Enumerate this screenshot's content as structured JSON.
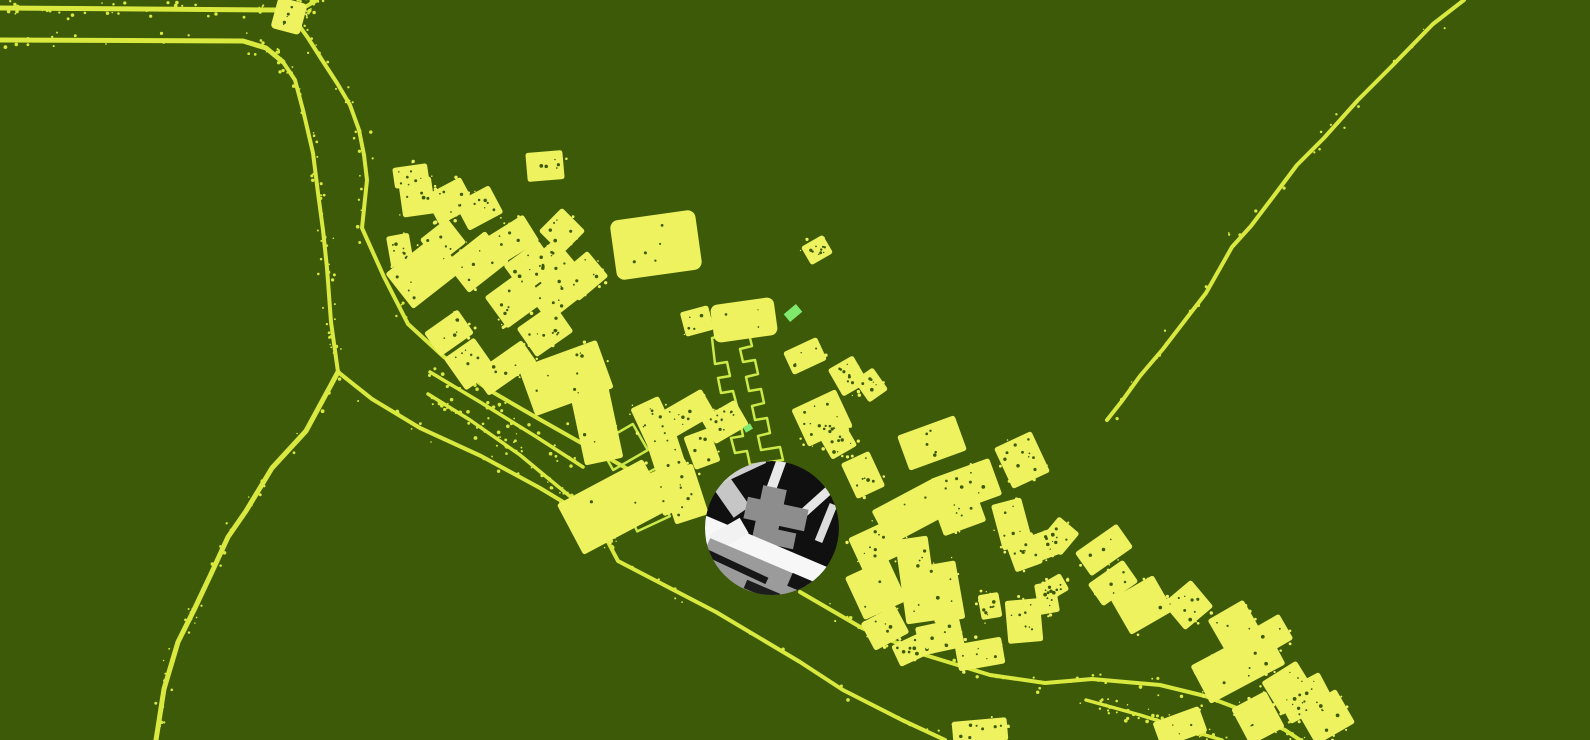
{
  "canvas": {
    "width": 1590,
    "height": 740
  },
  "colors": {
    "background": "#3c5a07",
    "building": "#eef25f",
    "road": "#d9e93f",
    "outline": "#cdea48",
    "accent_green": "#7fe96d",
    "lens_black": "#101010",
    "lens_white": "#f7f7f7",
    "lens_gray": "#9b9b9b"
  },
  "map": {
    "roads": [
      {
        "pts": [
          [
            0,
            8
          ],
          [
            278,
            10
          ]
        ],
        "w": 5
      },
      {
        "pts": [
          [
            300,
            10
          ],
          [
            317,
            0
          ]
        ],
        "w": 4
      },
      {
        "pts": [
          [
            0,
            40
          ],
          [
            243,
            41
          ],
          [
            266,
            48
          ],
          [
            283,
            62
          ]
        ],
        "w": 5
      },
      {
        "pts": [
          [
            283,
            62
          ],
          [
            295,
            80
          ],
          [
            303,
            110
          ],
          [
            313,
            153
          ],
          [
            318,
            193
          ],
          [
            323,
            230
          ],
          [
            327,
            268
          ],
          [
            331,
            322
          ],
          [
            338,
            372
          ]
        ],
        "w": 4
      },
      {
        "pts": [
          [
            298,
            24
          ],
          [
            308,
            38
          ],
          [
            322,
            60
          ],
          [
            337,
            83
          ],
          [
            350,
            105
          ],
          [
            359,
            130
          ],
          [
            364,
            155
          ],
          [
            367,
            180
          ],
          [
            362,
            228
          ],
          [
            384,
            277
          ],
          [
            408,
            324
          ],
          [
            444,
            357
          ],
          [
            489,
            390
          ],
          [
            539,
            419
          ],
          [
            592,
            449
          ],
          [
            642,
            477
          ],
          [
            690,
            503
          ]
        ],
        "w": 4
      },
      {
        "pts": [
          [
            338,
            372
          ],
          [
            306,
            431
          ],
          [
            272,
            468
          ],
          [
            246,
            511
          ],
          [
            228,
            537
          ],
          [
            211,
            574
          ],
          [
            194,
            610
          ],
          [
            178,
            642
          ],
          [
            164,
            689
          ],
          [
            156,
            740
          ]
        ],
        "w": 5
      },
      {
        "pts": [
          [
            338,
            372
          ],
          [
            372,
            399
          ],
          [
            420,
            428
          ],
          [
            481,
            456
          ],
          [
            540,
            488
          ],
          [
            598,
            523
          ],
          [
            618,
            561
          ],
          [
            666,
            586
          ],
          [
            716,
            612
          ],
          [
            800,
            662
          ],
          [
            843,
            690
          ],
          [
            902,
            720
          ],
          [
            945,
            740
          ]
        ],
        "w": 4
      },
      {
        "pts": [
          [
            800,
            592
          ],
          [
            862,
            628
          ],
          [
            925,
            655
          ],
          [
            990,
            675
          ],
          [
            1045,
            683
          ],
          [
            1092,
            679
          ],
          [
            1160,
            685
          ],
          [
            1205,
            696
          ],
          [
            1250,
            713
          ],
          [
            1285,
            730
          ],
          [
            1300,
            740
          ]
        ],
        "w": 4
      },
      {
        "pts": [
          [
            430,
            372
          ],
          [
            480,
            402
          ],
          [
            535,
            436
          ],
          [
            583,
            467
          ]
        ],
        "w": 3.5
      },
      {
        "pts": [
          [
            428,
            394
          ],
          [
            470,
            420
          ],
          [
            520,
            455
          ],
          [
            578,
            503
          ]
        ],
        "w": 3.5
      },
      {
        "pts": [
          [
            1086,
            700
          ],
          [
            1140,
            715
          ],
          [
            1195,
            732
          ],
          [
            1222,
            740
          ]
        ],
        "w": 3.5
      },
      {
        "pts": [
          [
            1464,
            0
          ],
          [
            1433,
            24
          ],
          [
            1392,
            66
          ],
          [
            1358,
            100
          ],
          [
            1324,
            138
          ],
          [
            1297,
            165
          ],
          [
            1276,
            193
          ],
          [
            1251,
            226
          ],
          [
            1232,
            247
          ],
          [
            1206,
            293
          ],
          [
            1186,
            319
          ],
          [
            1163,
            349
          ],
          [
            1140,
            376
          ],
          [
            1122,
            401
          ],
          [
            1107,
            420
          ]
        ],
        "w": 4
      }
    ],
    "buildings": [
      [
        289,
        16,
        22,
        24,
        15,
        8
      ],
      [
        411,
        176,
        30,
        16,
        -8
      ],
      [
        417,
        197,
        28,
        32,
        -8
      ],
      [
        450,
        201,
        36,
        28,
        -28
      ],
      [
        479,
        208,
        34,
        26,
        -28
      ],
      [
        400,
        250,
        18,
        26,
        -10
      ],
      [
        424,
        272,
        58,
        40,
        -38
      ],
      [
        443,
        241,
        30,
        26,
        -38
      ],
      [
        477,
        262,
        46,
        34,
        -38
      ],
      [
        513,
        239,
        38,
        26,
        -32
      ],
      [
        531,
        267,
        38,
        30,
        -36
      ],
      [
        562,
        231,
        28,
        28,
        -45
      ],
      [
        551,
        264,
        34,
        28,
        -40
      ],
      [
        515,
        299,
        42,
        34,
        -36
      ],
      [
        555,
        295,
        38,
        30,
        -38
      ],
      [
        583,
        276,
        34,
        28,
        -40
      ],
      [
        545,
        166,
        32,
        24,
        -5
      ],
      [
        656,
        245,
        70,
        44,
        -8,
        16
      ],
      [
        817,
        250,
        20,
        16,
        -30
      ],
      [
        697,
        321,
        24,
        20,
        -15
      ],
      [
        744,
        320,
        50,
        24,
        -8,
        14
      ],
      [
        449,
        333,
        36,
        24,
        -35
      ],
      [
        470,
        364,
        32,
        34,
        -35
      ],
      [
        505,
        368,
        54,
        22,
        -35
      ],
      [
        545,
        330,
        40,
        30,
        -35
      ],
      [
        566,
        378,
        78,
        46,
        -20
      ],
      [
        595,
        418,
        34,
        84,
        -12
      ],
      [
        688,
        413,
        42,
        24,
        -30
      ],
      [
        725,
        422,
        34,
        24,
        -30
      ],
      [
        702,
        449,
        22,
        30,
        -20
      ],
      [
        653,
        421,
        26,
        36,
        -25
      ],
      [
        674,
        487,
        38,
        40,
        -25
      ],
      [
        613,
        507,
        92,
        52,
        -28
      ],
      [
        665,
        450,
        26,
        44,
        -18
      ],
      [
        684,
        494,
        30,
        48,
        -18
      ],
      [
        805,
        356,
        32,
        20,
        -25
      ],
      [
        848,
        376,
        24,
        26,
        -30
      ],
      [
        871,
        385,
        18,
        22,
        -35
      ],
      [
        822,
        418,
        44,
        36,
        -25
      ],
      [
        827,
        428,
        16,
        14,
        -25
      ],
      [
        838,
        441,
        24,
        22,
        -30
      ],
      [
        863,
        475,
        26,
        34,
        -25
      ],
      [
        932,
        443,
        56,
        32,
        -20
      ],
      [
        966,
        487,
        58,
        34,
        -20
      ],
      [
        960,
        514,
        40,
        26,
        -20
      ],
      [
        1022,
        460,
        36,
        40,
        -25
      ],
      [
        1012,
        524,
        26,
        42,
        -15
      ],
      [
        1024,
        552,
        24,
        28,
        -20
      ],
      [
        1042,
        546,
        30,
        22,
        -20
      ],
      [
        1060,
        536,
        24,
        22,
        -50
      ],
      [
        911,
        512,
        64,
        34,
        -28
      ],
      [
        878,
        545,
        44,
        32,
        -25
      ],
      [
        917,
        580,
        28,
        80,
        -8
      ],
      [
        945,
        592,
        26,
        54,
        -10
      ],
      [
        876,
        589,
        42,
        42,
        -25
      ],
      [
        885,
        628,
        34,
        26,
        -28
      ],
      [
        910,
        650,
        26,
        18,
        -25
      ],
      [
        990,
        606,
        16,
        20,
        -10
      ],
      [
        1024,
        621,
        30,
        38,
        -5
      ],
      [
        1047,
        598,
        16,
        26,
        -10
      ],
      [
        940,
        637,
        40,
        24,
        -12
      ],
      [
        1104,
        550,
        46,
        24,
        -35
      ],
      [
        1113,
        583,
        38,
        22,
        -35
      ],
      [
        1053,
        588,
        22,
        14,
        -30
      ],
      [
        1142,
        605,
        44,
        36,
        -30
      ],
      [
        1188,
        605,
        32,
        30,
        -40
      ],
      [
        1234,
        625,
        36,
        30,
        -30
      ],
      [
        1271,
        635,
        30,
        24,
        -30
      ],
      [
        1238,
        665,
        80,
        38,
        -28
      ],
      [
        1289,
        688,
        36,
        34,
        -32
      ],
      [
        1305,
        698,
        44,
        28,
        -28
      ],
      [
        1326,
        717,
        40,
        34,
        -30
      ],
      [
        1258,
        718,
        34,
        36,
        -28
      ],
      [
        1180,
        727,
        44,
        22,
        -20
      ],
      [
        980,
        654,
        42,
        22,
        -10
      ],
      [
        980,
        731,
        50,
        18,
        -5
      ]
    ],
    "outline_rects": [
      [
        623,
        447,
        40,
        30,
        -30
      ],
      [
        666,
        480,
        40,
        30,
        -28
      ],
      [
        648,
        512,
        36,
        26,
        -25
      ]
    ],
    "outline_path": "712,338 748,330 752,346 740,349 743,362 755,360 758,374 746,377 749,391 761,389 764,403 752,406 755,420 767,418 770,433 758,436 761,450 780,447 783,460 750,465 747,451 735,453 731,438 743,436 740,421 728,423 725,408 737,406 733,391 721,393 718,378 730,376 727,362 715,364",
    "accents": [
      [
        793,
        313,
        16,
        10,
        -40
      ],
      [
        748,
        428,
        8,
        6,
        -30
      ]
    ],
    "inset": {
      "cx": 772,
      "cy": 528,
      "r": 67,
      "shapes": [
        [
          723,
          485,
          20,
          66,
          -35,
          "#c6c6c6"
        ],
        [
          741,
          468,
          50,
          12,
          -25,
          "#cfcfcf"
        ],
        [
          777,
          473,
          10,
          44,
          20,
          "#e9e9e9"
        ],
        [
          818,
          500,
          48,
          9,
          -42,
          "#e6e6e6"
        ],
        [
          826,
          523,
          8,
          40,
          22,
          "#dcdcdc"
        ],
        [
          776,
          514,
          62,
          22,
          12,
          "#8d8d8d"
        ],
        [
          769,
          516,
          24,
          58,
          12,
          "#8d8d8d"
        ],
        [
          779,
          538,
          32,
          16,
          12,
          "#8d8d8d"
        ],
        [
          763,
          554,
          148,
          26,
          23,
          "#f7f7f7"
        ],
        [
          726,
          536,
          42,
          18,
          -30,
          "#f2f2f2"
        ],
        [
          772,
          610,
          170,
          84,
          23,
          "#9b9b9b"
        ],
        [
          737,
          567,
          66,
          7,
          25,
          "#161616"
        ],
        [
          762,
          591,
          36,
          9,
          23,
          "#1c1c1c"
        ],
        [
          801,
          584,
          24,
          14,
          23,
          "#131313"
        ]
      ]
    },
    "speckle": {
      "seed": 7,
      "road_dots": 520,
      "edge_dots": 320,
      "hole_dots": 420
    }
  }
}
